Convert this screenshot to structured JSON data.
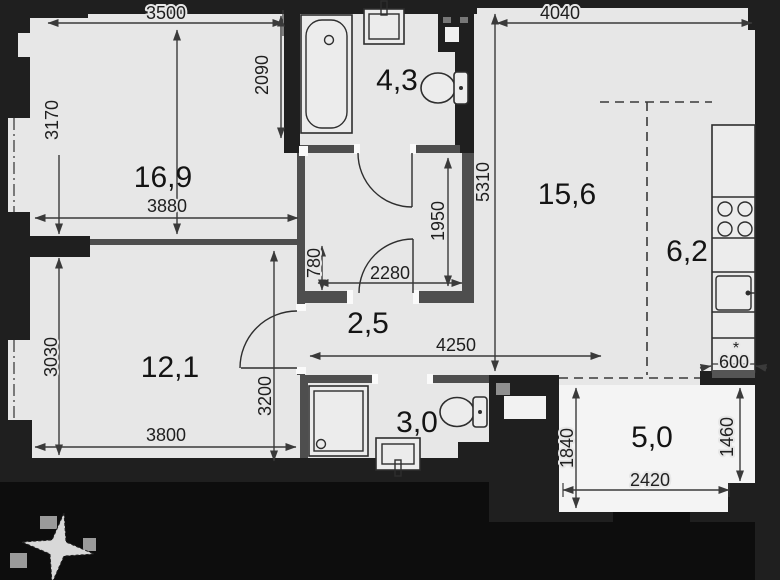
{
  "rooms": {
    "living": "16,9",
    "bathroom": "4,3",
    "kitchen_living": "15,6",
    "kitchen_zone": "6,2",
    "hallway": "2,5",
    "bedroom": "12,1",
    "shower_room": "3,0",
    "balcony": "5,0"
  },
  "dimensions": {
    "living_top_width": "3500",
    "right_top_width": "4040",
    "bath_depth": "2090",
    "living_height": "3170",
    "living_bottom_width": "3880",
    "right_side_height": "5310",
    "inner_hall_height": "1950",
    "inner_hall_width": "2280",
    "wall_offset": "780",
    "bedroom_height_left": "3030",
    "bedroom_height_right": "3200",
    "bedroom_width": "3800",
    "corridor_span": "4250",
    "counter_depth": "600",
    "counter_note": "*",
    "balcony_height_left": "1840",
    "balcony_height_right": "1460",
    "balcony_width": "2420"
  },
  "colors": {
    "wall": "#1f1f1f",
    "partition": "#4e4e4e",
    "floor": "#e7e7e7",
    "balcony_floor": "#f4f4f4",
    "dimension_line": "#3a3a3a"
  }
}
